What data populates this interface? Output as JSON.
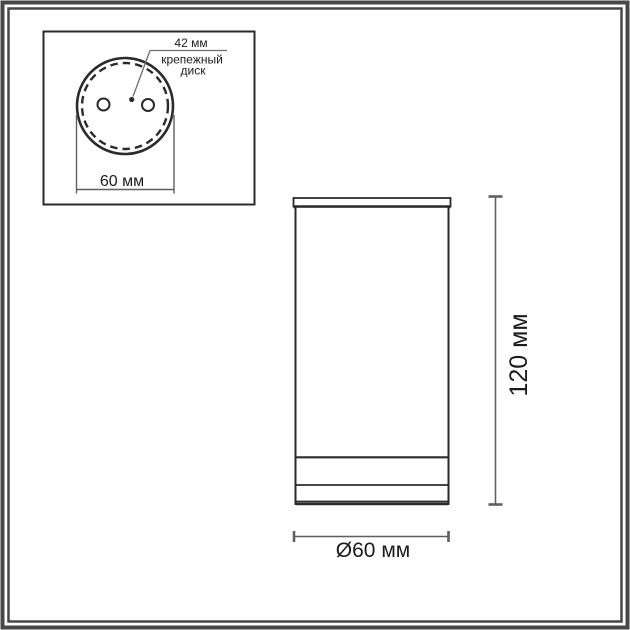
{
  "colors": {
    "background": "#ffffff",
    "line": "#2b2b2b",
    "dimension": "#5f5f5f",
    "leader": "#6e6e6e",
    "text": "#1c1c1c",
    "frame": "#474747"
  },
  "top_view_inset": {
    "disk_diameter_label": "42 мм",
    "disk_name_line1": "крепежный",
    "disk_name_line2": "диск",
    "base_width_label": "60 мм"
  },
  "side_view": {
    "height_label": "120 мм",
    "diameter_label": "Ø60 мм"
  }
}
